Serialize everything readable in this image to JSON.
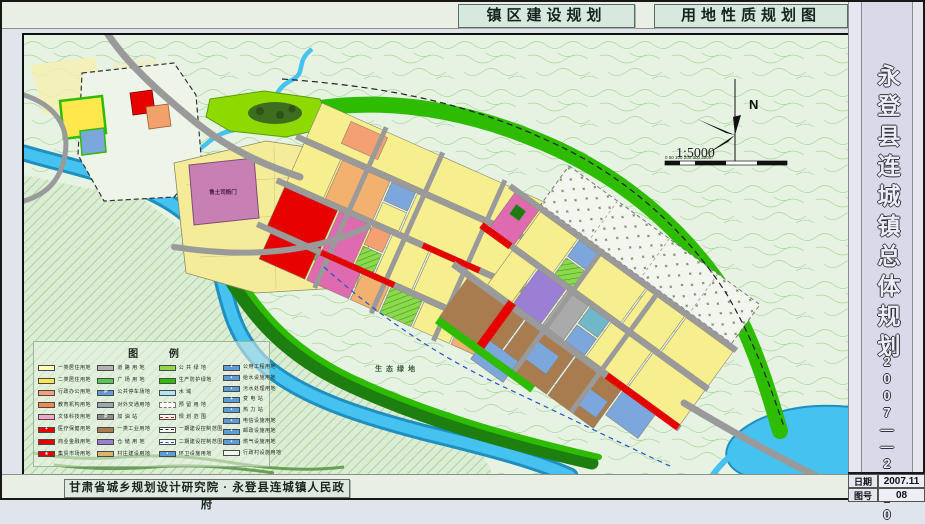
{
  "header": {
    "title_left": "镇区建设规划",
    "title_right": "用地性质规划图"
  },
  "sidebar": {
    "title": "永登县连城镇总体规划",
    "years": "2007——2020"
  },
  "infobox": {
    "date_label": "日期",
    "date_value": "2007.11",
    "sheet_label": "图号",
    "sheet_value": "08"
  },
  "footer": {
    "credit": "甘肃省城乡规划设计研究院 · 永登县连城镇人民政府"
  },
  "map": {
    "labels": {
      "landmark": "鲁土司衙门",
      "eco": "生态绿地"
    },
    "compass": {
      "north": "N"
    },
    "scale": {
      "ratio": "1:5000",
      "ticks": [
        "0",
        "50",
        "100",
        "200",
        "300",
        "400m"
      ]
    }
  },
  "colors": {
    "residential1": "#ffffbe",
    "residential2": "#ffe84d",
    "admin": "#f4a072",
    "education": "#ef8a4e",
    "culture": "#f2a6c8",
    "commerce": "#e60000",
    "road": "#b3b3b3",
    "industry": "#a97c50",
    "warehouse": "#9b7fd4",
    "utility_blue": "#5f9bd8",
    "public_green": "#8ed94a",
    "protect_green": "#2ebc00",
    "water": "#35b5ea"
  },
  "legend": {
    "title": "图  例",
    "columns": [
      [
        {
          "label": "一类居住用地",
          "fill": "#ffffbe"
        },
        {
          "label": "二类居住用地",
          "fill": "#ffe84d"
        },
        {
          "label": "行政办公用地",
          "fill": "#f4a072"
        },
        {
          "label": "教育机构用地",
          "fill": "#ef8a4e"
        },
        {
          "label": "文体科技用地",
          "fill": "#f2a6c8"
        },
        {
          "label": "医疗保健用地",
          "fill": "#e60000",
          "icon": "cross"
        },
        {
          "label": "商业金融用地",
          "fill": "#e60000"
        },
        {
          "label": "集贸市场用地",
          "fill": "#e60000",
          "icon": "star"
        }
      ],
      [
        {
          "label": "道 路 用 地",
          "fill": "#b3b3b3"
        },
        {
          "label": "广 场 用 地",
          "fill": "#57c84d",
          "hatch": true
        },
        {
          "label": "公共停车场地",
          "fill": "#5f9bd8",
          "icon": "parking"
        },
        {
          "label": "对外交通用地",
          "fill": "#9aa7b0"
        },
        {
          "label": "加  油  站",
          "fill": "#8f8f8f",
          "icon": "parking"
        },
        {
          "label": "一类工业用地",
          "fill": "#a97c50"
        },
        {
          "label": "仓 储 用 地",
          "fill": "#9b7fd4"
        },
        {
          "label": "村庄建设用地",
          "fill": "#dcb36a"
        }
      ],
      [
        {
          "label": "公 共 绿 地",
          "fill": "#8ed94a",
          "hatch": true
        },
        {
          "label": "生产防护绿地",
          "fill": "#2ebc00"
        },
        {
          "label": "水      域",
          "fill": "#aee6f5"
        },
        {
          "label": "预 留 用 地",
          "dashedBox": true
        },
        {
          "label": "规 划 范 围",
          "line": {
            "color": "#e60000"
          }
        },
        {
          "label": "一期建设控制范围",
          "line": {
            "color": "#222222"
          }
        },
        {
          "label": "二期建设控制范围",
          "line": {
            "color": "#2255cc"
          }
        },
        {
          "label": "环卫设施用地",
          "fill": "#5f9bd8",
          "icon": "dot"
        }
      ],
      [
        {
          "label": "公用工程用地",
          "fill": "#5f9bd8",
          "icon": "dot"
        },
        {
          "label": "给水设施用地",
          "fill": "#5f9bd8",
          "icon": "dot"
        },
        {
          "label": "污水处理用地",
          "fill": "#5f9bd8",
          "icon": "dot"
        },
        {
          "label": "变  电  站",
          "fill": "#5f9bd8",
          "icon": "cross"
        },
        {
          "label": "热  力  站",
          "fill": "#5f9bd8",
          "icon": "dot"
        },
        {
          "label": "电信设施用地",
          "fill": "#5f9bd8",
          "icon": "dot"
        },
        {
          "label": "邮政设施用地",
          "fill": "#5f9bd8",
          "icon": "dot"
        },
        {
          "label": "燃气设施用地",
          "fill": "#5f9bd8",
          "icon": "dot"
        },
        {
          "label": "行政村设施用地",
          "fill": "#f2f4ef",
          "icon": "none"
        }
      ]
    ]
  }
}
